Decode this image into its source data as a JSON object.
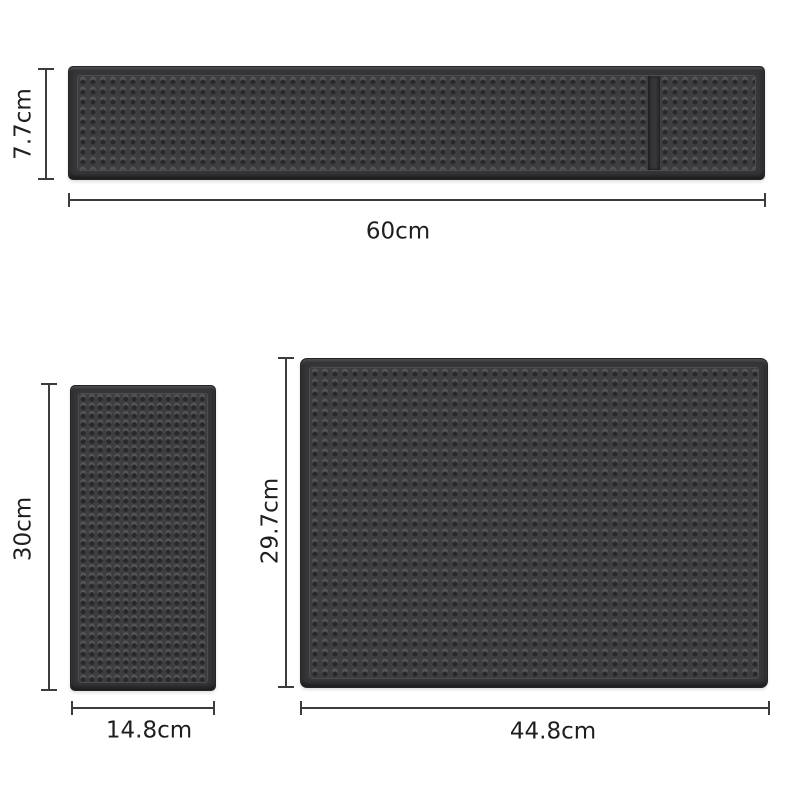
{
  "diagram": {
    "description": "Rubber bar mat product dimension diagram with three mats",
    "mats": {
      "bar": {
        "name": "long bar mat with divided end section",
        "width_label": "60cm",
        "height_label": "7.7cm"
      },
      "small": {
        "name": "small vertical mat",
        "width_label": "14.8cm",
        "height_label": "30cm"
      },
      "large": {
        "name": "large service mat",
        "width_label": "44.8cm",
        "height_label": "29.7cm"
      }
    }
  },
  "colors": {
    "background": "#ffffff",
    "mat_base": "#37373a",
    "mat_surface": "#3e3e41",
    "mat_edge": "#242427",
    "dot_shadow": "#28282b",
    "dot_highlight": "#55555a",
    "dimension_line": "#3c3c3c",
    "label_text": "#1e1e1e"
  }
}
